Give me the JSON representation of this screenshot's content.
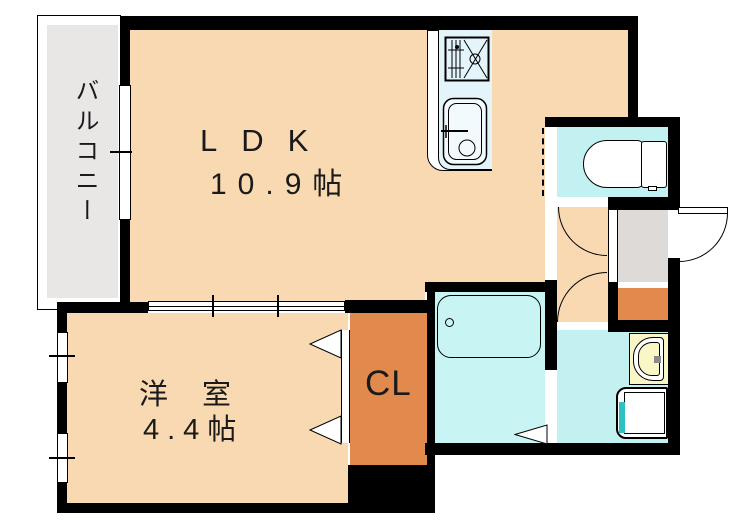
{
  "title": "apartment-floor-plan",
  "colors": {
    "peach": "#f8d9b2",
    "balcony-gray": "#e9e6e6",
    "entrance-gray": "#dedad7",
    "orange": "#e28a4e",
    "cyan": "#c3f0f1",
    "bath-cyan": "#c9f4f4",
    "counter-blue": "#e4f4fb",
    "basin-yellow": "#faf7c6",
    "teal": "#2cc2c4",
    "wall": "#000000",
    "ink": "#1a1a1a"
  },
  "rooms": {
    "balcony": {
      "label": "バルコニー"
    },
    "ldk": {
      "label": "LDK",
      "area": "10.9帖"
    },
    "western_room": {
      "label": "洋室",
      "area": "4.4帖"
    },
    "closet": {
      "label": "CL"
    }
  }
}
